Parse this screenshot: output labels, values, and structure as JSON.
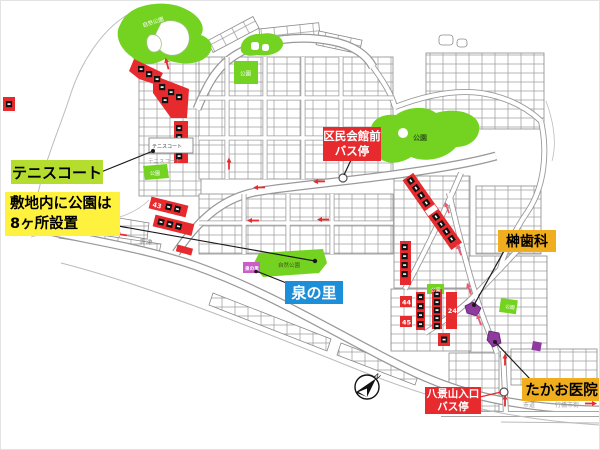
{
  "callouts": {
    "tennis_court": {
      "label": "テニスコート"
    },
    "parks_note": {
      "line1": "敷地内に公園は",
      "line2": "8ヶ所設置"
    },
    "izumi_no_sato": {
      "label": "泉の里"
    },
    "kumin_hall_bus_stop": {
      "line1": "区民会館前",
      "line2": "バス停"
    },
    "sakaki_dental": {
      "label": "榊歯科"
    },
    "hakkeizan_bus_stop": {
      "line1": "八景山入口",
      "line2": "バス停"
    },
    "takao_clinic": {
      "label": "たかお医院"
    }
  },
  "map_labels": {
    "nature_park": "自然公園",
    "park": "公園",
    "tennis_box": "テニスコート",
    "tennis_small": "テニスコート",
    "izumi_marker": "泉の里",
    "toyotsu": "豊津",
    "shido": "市道",
    "yukuhashi_city": "行橋市街",
    "north": "N"
  },
  "lot_numbers": {
    "l43": "43",
    "l44": "44",
    "l45": "45",
    "l24": "24"
  },
  "colors": {
    "red": "#e72a2e",
    "orange": "#f0ad1e",
    "yellow": "#fff23e",
    "yellow_green": "#b4dd30",
    "blue": "#1d8ed8",
    "map_green": "#74d321",
    "purple": "#8e3a9e",
    "magenta": "#c75fc7"
  }
}
